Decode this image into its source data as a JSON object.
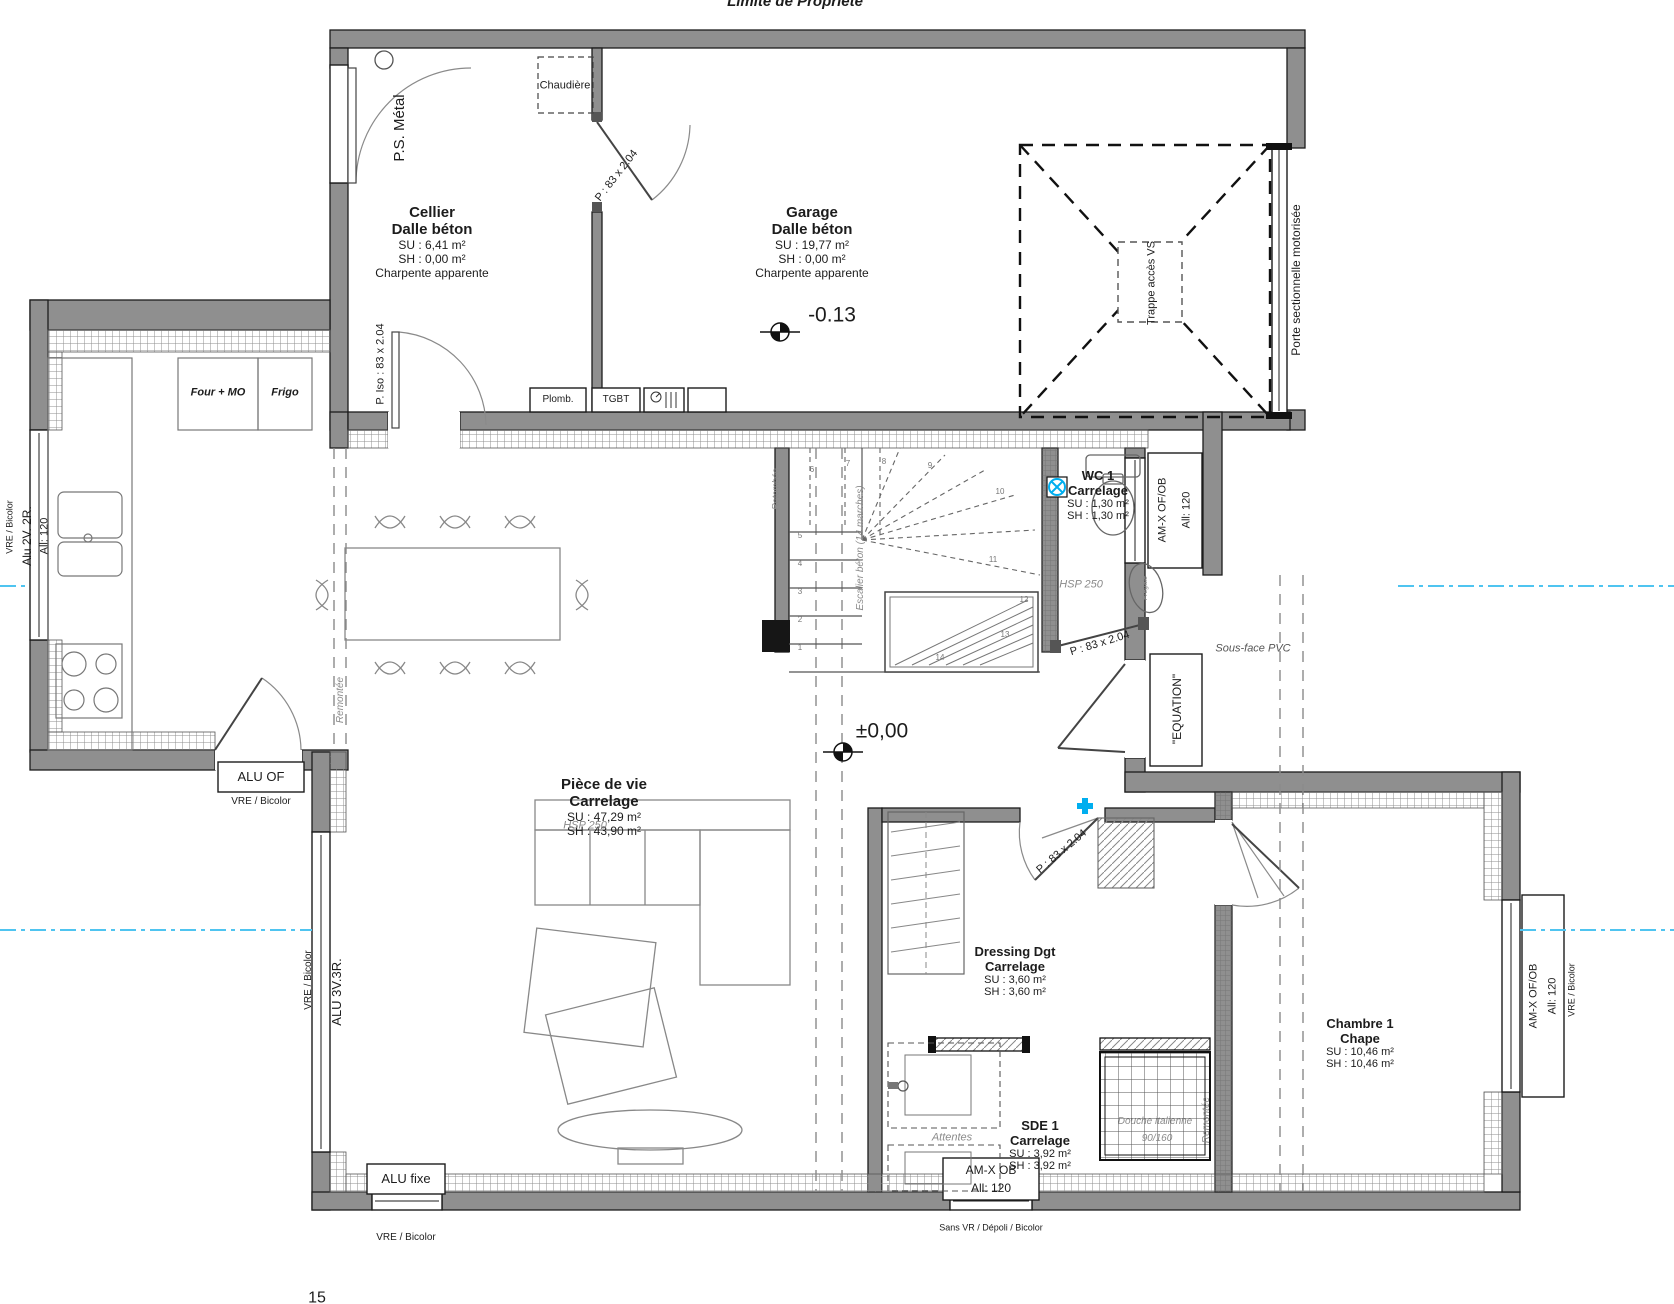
{
  "plan": {
    "property_line": "Limite de Propriété",
    "sheet_no": "15"
  },
  "rooms": {
    "cellier": {
      "name": "Cellier",
      "floor": "Dalle béton",
      "su": "SU : 6,41 m²",
      "sh": "SH : 0,00 m²",
      "note": "Charpente apparente"
    },
    "garage": {
      "name": "Garage",
      "floor": "Dalle béton",
      "su": "SU : 19,77 m²",
      "sh": "SH : 0,00 m²",
      "note": "Charpente apparente",
      "level": "-0.13"
    },
    "wc1": {
      "name": "WC 1",
      "floor": "Carrelage",
      "su": "SU : 1,30 m²",
      "sh": "SH : 1,30 m²",
      "hsp": "HSP 250"
    },
    "piece": {
      "name": "Pièce de vie",
      "floor": "Carrelage",
      "su": "SU : 47,29 m²",
      "sh": "SH : 43,90 m²",
      "hsp": "HSP 250",
      "level": "±0,00"
    },
    "dressing": {
      "name": "Dressing Dgt",
      "floor": "Carrelage",
      "su": "SU : 3,60 m²",
      "sh": "SH : 3,60 m²"
    },
    "sde1": {
      "name": "SDE 1",
      "floor": "Carrelage",
      "su": "SU : 3,92 m²",
      "sh": "SH : 3,92 m²"
    },
    "chambre1": {
      "name": "Chambre 1",
      "floor": "Chape",
      "su": "SU : 10,46 m²",
      "sh": "SH : 10,46 m²"
    }
  },
  "doors": {
    "ps_metal": "P.S. Métal",
    "p83": "P : 83 x 2.04",
    "p_iso": "P. Iso : 83 x 2.04",
    "sectionnelle": "Porte sectionnelle motorisée",
    "equation": "\"EQUATION\""
  },
  "fixtures": {
    "chaudiere": "Chaudière",
    "plomb": "Plomb.",
    "tgbt": "TGBT",
    "four_mo": "Four + MO",
    "frigo": "Frigo",
    "trappe": "Trappe accès VS",
    "attentes": "Attentes",
    "douche1": "Douche italienne",
    "douche2": "90/160",
    "fregate": "Frégate"
  },
  "windows": {
    "kitchen": {
      "type": "Alu 2V. 2R.",
      "height": "All: 120",
      "glazing": "VRE / Bicolor"
    },
    "alu_of": {
      "type": "ALU OF",
      "glazing": "VRE / Bicolor"
    },
    "bay": {
      "type": "ALU 3V.3R.",
      "glazing": "VRE / Bicolor"
    },
    "fixed": {
      "type": "ALU fixe",
      "glazing": "VRE / Bicolor"
    },
    "wc": {
      "type": "AM-X OF/OB",
      "height": "All: 120"
    },
    "sde": {
      "type": "AM-X OB",
      "height": "All: 120",
      "note": "Sans VR / Dépoli / Bicolor"
    },
    "chambre": {
      "type": "AM-X OF/OB",
      "height": "All: 120",
      "glazing": "VRE / Bicolor"
    }
  },
  "ann": {
    "sous_face": "Sous-face PVC",
    "retombee": "Retombée",
    "remontee": "Remontée",
    "escalier": "Escalier béton (14 marches)"
  },
  "stairs": {
    "numbers": [
      "1",
      "2",
      "3",
      "4",
      "5",
      "6",
      "7",
      "8",
      "9",
      "10",
      "11",
      "12",
      "13",
      "14"
    ]
  },
  "colors": {
    "wall": "#8f8f8f",
    "line": "#1c1c1c",
    "accent_blue": "#00aeef",
    "axis_blue": "#4fc4f0",
    "gray_text": "#8a8a8a"
  }
}
